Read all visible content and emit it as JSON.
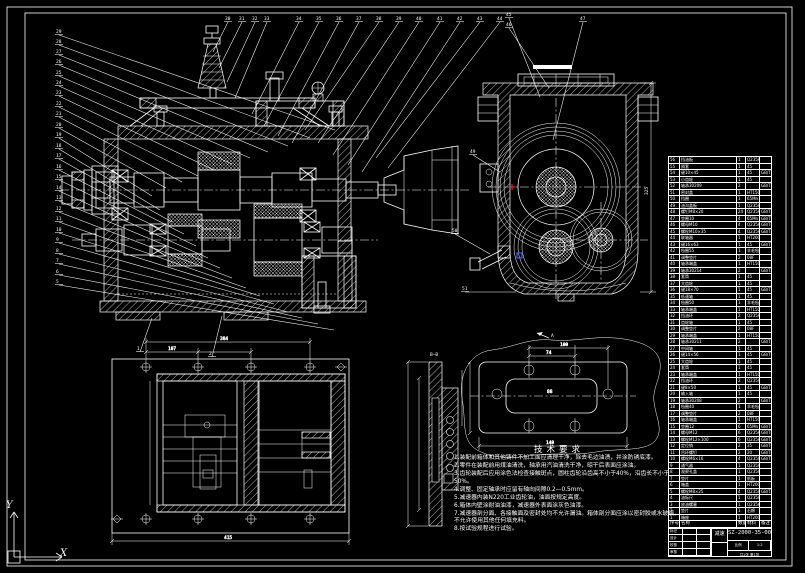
{
  "drawing": {
    "number": "SZ-2000-35-00",
    "title_block": {
      "name": "减速器",
      "labels": [
        "标记",
        "设计",
        "校核",
        "审核"
      ],
      "scale_label": "比例",
      "scale": "1:2",
      "qty_label": "数量",
      "sheet": "共1张 第1张"
    },
    "tech_requirements": {
      "title": "技术要求",
      "items": [
        "装配前箱体和其他铸件不加工面应清理干净，除去毛边油渍，并涂防锈底漆。",
        "零件在装配前用煤油清洗，轴承用汽油清洗干净，晾干后表面应涂油。",
        "齿轮装配后应用涂色法检查接触斑点，圆柱齿轮沿齿高不小于40%，沿齿长不小于50%。",
        "调整、固定轴承时应留有轴向间隙0.2—0.5mm。",
        "减速器内装N220工业齿轮油，油面按规定高度。",
        "箱体内壁涂耐油油漆，减速器外表面涂灰色油漆。",
        "减速器剖分面、各接触面及密封处均不允许漏油。箱体剖分面应涂以密封胶或水玻璃，不允许使用其他任何填充料。",
        "按试验规程进行试验。"
      ]
    },
    "section_labels": {
      "section": "B—B",
      "view_dir": "A"
    },
    "dims": {
      "side_height": "325",
      "plan_w1": "384",
      "plan_w2": "107",
      "plan_w3": "415",
      "cover_w1": "100",
      "cover_w2": "74",
      "cover_w3": "88",
      "cover_w4": "140"
    },
    "balloons": [
      {
        "n": 30,
        "x": 225,
        "y": 20,
        "tx": 213,
        "ty": 52
      },
      {
        "n": 31,
        "x": 239,
        "y": 20,
        "tx": 219,
        "ty": 68
      },
      {
        "n": 32,
        "x": 252,
        "y": 20,
        "tx": 227,
        "ty": 82
      },
      {
        "n": 33,
        "x": 264,
        "y": 20,
        "tx": 235,
        "ty": 98
      },
      {
        "n": 34,
        "x": 296,
        "y": 20,
        "tx": 252,
        "ty": 114
      },
      {
        "n": 35,
        "x": 316,
        "y": 20,
        "tx": 264,
        "ty": 126
      },
      {
        "n": 36,
        "x": 336,
        "y": 20,
        "tx": 278,
        "ty": 136
      },
      {
        "n": 37,
        "x": 356,
        "y": 20,
        "tx": 292,
        "ty": 143
      },
      {
        "n": 38,
        "x": 376,
        "y": 20,
        "tx": 305,
        "ty": 130
      },
      {
        "n": 39,
        "x": 396,
        "y": 20,
        "tx": 318,
        "ty": 143
      },
      {
        "n": 40,
        "x": 416,
        "y": 20,
        "tx": 333,
        "ty": 155
      },
      {
        "n": 41,
        "x": 437,
        "y": 20,
        "tx": 348,
        "ty": 165
      },
      {
        "n": 42,
        "x": 457,
        "y": 20,
        "tx": 362,
        "ty": 172
      },
      {
        "n": 43,
        "x": 477,
        "y": 20,
        "tx": 376,
        "ty": 158
      },
      {
        "n": 44,
        "x": 497,
        "y": 20,
        "tx": 388,
        "ty": 168
      },
      {
        "n": 45,
        "x": 506,
        "y": 16,
        "tx": 540,
        "ty": 97
      },
      {
        "n": 46,
        "x": 506,
        "y": 26,
        "tx": 549,
        "ty": 88
      },
      {
        "n": 47,
        "x": 580,
        "y": 20,
        "tx": 553,
        "ty": 140
      },
      {
        "n": 29,
        "x": 56,
        "y": 33,
        "tx": 335,
        "ty": 130
      },
      {
        "n": 28,
        "x": 56,
        "y": 43,
        "tx": 310,
        "ty": 138
      },
      {
        "n": 27,
        "x": 56,
        "y": 53,
        "tx": 288,
        "ty": 146
      },
      {
        "n": 26,
        "x": 56,
        "y": 63,
        "tx": 268,
        "ty": 152
      },
      {
        "n": 25,
        "x": 56,
        "y": 74,
        "tx": 250,
        "ty": 158
      },
      {
        "n": 24,
        "x": 56,
        "y": 84,
        "tx": 232,
        "ty": 164
      },
      {
        "n": 23,
        "x": 56,
        "y": 94,
        "tx": 214,
        "ty": 170
      },
      {
        "n": 22,
        "x": 56,
        "y": 105,
        "tx": 198,
        "ty": 176
      },
      {
        "n": 21,
        "x": 56,
        "y": 115,
        "tx": 182,
        "ty": 182
      },
      {
        "n": 20,
        "x": 56,
        "y": 126,
        "tx": 166,
        "ty": 188
      },
      {
        "n": 19,
        "x": 56,
        "y": 136,
        "tx": 152,
        "ty": 196
      },
      {
        "n": 18,
        "x": 56,
        "y": 147,
        "tx": 160,
        "ty": 210
      },
      {
        "n": 17,
        "x": 56,
        "y": 157,
        "tx": 172,
        "ty": 222
      },
      {
        "n": 16,
        "x": 56,
        "y": 168,
        "tx": 184,
        "ty": 234
      },
      {
        "n": 15,
        "x": 56,
        "y": 178,
        "tx": 196,
        "ty": 246
      },
      {
        "n": 14,
        "x": 56,
        "y": 189,
        "tx": 208,
        "ty": 258
      },
      {
        "n": 13,
        "x": 56,
        "y": 199,
        "tx": 220,
        "ty": 268
      },
      {
        "n": 12,
        "x": 56,
        "y": 210,
        "tx": 232,
        "ty": 278
      },
      {
        "n": 11,
        "x": 56,
        "y": 220,
        "tx": 246,
        "ty": 288
      },
      {
        "n": 10,
        "x": 56,
        "y": 231,
        "tx": 260,
        "ty": 296
      },
      {
        "n": 9,
        "x": 56,
        "y": 241,
        "tx": 274,
        "ty": 304
      },
      {
        "n": 8,
        "x": 56,
        "y": 252,
        "tx": 288,
        "ty": 312
      },
      {
        "n": 7,
        "x": 56,
        "y": 262,
        "tx": 302,
        "ty": 318
      },
      {
        "n": 6,
        "x": 56,
        "y": 273,
        "tx": 318,
        "ty": 324
      },
      {
        "n": 5,
        "x": 56,
        "y": 283,
        "tx": 334,
        "ty": 330
      },
      {
        "n": 49,
        "x": 470,
        "y": 153,
        "tx": 500,
        "ty": 172
      },
      {
        "n": 50,
        "x": 452,
        "y": 232,
        "tx": 490,
        "ty": 254
      },
      {
        "n": 51,
        "x": 462,
        "y": 290,
        "tx": 516,
        "ty": 292
      },
      {
        "n": 1,
        "x": 137,
        "y": 350,
        "tx": 152,
        "ty": 318
      },
      {
        "n": 2,
        "x": 209,
        "y": 355,
        "tx": 222,
        "ty": 316
      }
    ],
    "parts_list": {
      "headers": [
        "序号",
        "名称",
        "数量",
        "材料",
        "备注"
      ],
      "rows": [
        [
          56,
          "挡油板",
          1,
          "Q235A",
          ""
        ],
        [
          55,
          "隔套",
          1,
          "45",
          ""
        ],
        [
          54,
          "键10×45",
          1,
          "45",
          "GB/T1096"
        ],
        [
          53,
          "小齿轮",
          1,
          "45",
          ""
        ],
        [
          52,
          "轴承30209",
          2,
          "",
          "GB/T297"
        ],
        [
          51,
          "密封盖",
          1,
          "HT150",
          ""
        ],
        [
          50,
          "挡圈",
          1,
          "65Mn",
          ""
        ],
        [
          49,
          "油沟盖板",
          1,
          "Q235A",
          ""
        ],
        [
          48,
          "螺钉M8×20",
          24,
          "Q235A",
          "GB/T5781"
        ],
        [
          47,
          "垫圈10",
          4,
          "65Mn",
          "GB/T93"
        ],
        [
          46,
          "螺母M10",
          4,
          "Q235A",
          "GB/T6170"
        ],
        [
          45,
          "螺栓M10×35",
          4,
          "Q235A",
          "GB/T5782"
        ],
        [
          44,
          "联轴器",
          1,
          "HT200",
          ""
        ],
        [
          43,
          "键16×63",
          1,
          "45",
          "GB/T1096"
        ],
        [
          42,
          "毡圈55",
          1,
          "羊毛毡",
          ""
        ],
        [
          41,
          "调整垫片",
          2,
          "08F",
          ""
        ],
        [
          40,
          "轴承端盖",
          1,
          "HT150",
          ""
        ],
        [
          39,
          "轴承30214",
          2,
          "",
          "GB/T297"
        ],
        [
          38,
          "套筒",
          1,
          "45",
          ""
        ],
        [
          37,
          "大齿轮",
          1,
          "45",
          ""
        ],
        [
          36,
          "键18×70",
          1,
          "45",
          "GB/T1096"
        ],
        [
          35,
          "低速轴",
          1,
          "45",
          ""
        ],
        [
          34,
          "毡圈50",
          1,
          "羊毛毡",
          ""
        ],
        [
          33,
          "轴承端盖",
          1,
          "HT150",
          ""
        ],
        [
          32,
          "挡油环",
          2,
          "Q235A",
          ""
        ],
        [
          31,
          "齿轮轴",
          1,
          "45",
          ""
        ],
        [
          30,
          "调整垫片",
          2,
          "08F",
          ""
        ],
        [
          29,
          "轴承端盖",
          1,
          "HT150",
          ""
        ],
        [
          28,
          "轴承30211",
          2,
          "",
          "GB/T297"
        ],
        [
          27,
          "中间轴",
          1,
          "45",
          ""
        ],
        [
          26,
          "键14×56",
          1,
          "45",
          "GB/T1096"
        ],
        [
          25,
          "大齿轮",
          1,
          "45",
          ""
        ],
        [
          24,
          "套筒",
          1,
          "45",
          ""
        ],
        [
          23,
          "轴承端盖",
          1,
          "HT150",
          ""
        ],
        [
          22,
          "挡油环",
          2,
          "Q235A",
          ""
        ],
        [
          21,
          "键8×50",
          1,
          "45",
          "GB/T1096"
        ],
        [
          20,
          "输入轴",
          1,
          "45",
          ""
        ],
        [
          19,
          "轴承30208",
          2,
          "",
          "GB/T297"
        ],
        [
          18,
          "毡圈40",
          1,
          "羊毛毡",
          ""
        ],
        [
          17,
          "调整垫片",
          2,
          "08F",
          ""
        ],
        [
          16,
          "轴承端盖",
          1,
          "HT150",
          ""
        ],
        [
          15,
          "垫圈12",
          6,
          "65Mn",
          "GB/T93"
        ],
        [
          14,
          "螺母M12",
          6,
          "Q235A",
          "GB/T6170"
        ],
        [
          13,
          "螺栓M12×100",
          6,
          "Q235A",
          "GB/T5782"
        ],
        [
          12,
          "定位销",
          2,
          "35",
          "GB/T117"
        ],
        [
          11,
          "吊环螺钉",
          2,
          "20",
          "GB/T825"
        ],
        [
          10,
          "螺栓M6×16",
          4,
          "Q235A",
          "GB/T5781"
        ],
        [
          9,
          "通气器",
          1,
          "Q235A",
          ""
        ],
        [
          8,
          "观察孔盖",
          1,
          "Q235A",
          ""
        ],
        [
          7,
          "垫片",
          1,
          "纸板",
          ""
        ],
        [
          6,
          "箱盖",
          1,
          "HT200",
          ""
        ],
        [
          5,
          "螺栓M8×25",
          4,
          "Q235A",
          "GB/T5781"
        ],
        [
          4,
          "油标尺",
          1,
          "Q235A",
          ""
        ],
        [
          3,
          "放油螺塞",
          1,
          "Q235A",
          ""
        ],
        [
          2,
          "垫片",
          1,
          "石棉",
          ""
        ],
        [
          1,
          "箱座",
          1,
          "HT200",
          ""
        ]
      ]
    }
  }
}
